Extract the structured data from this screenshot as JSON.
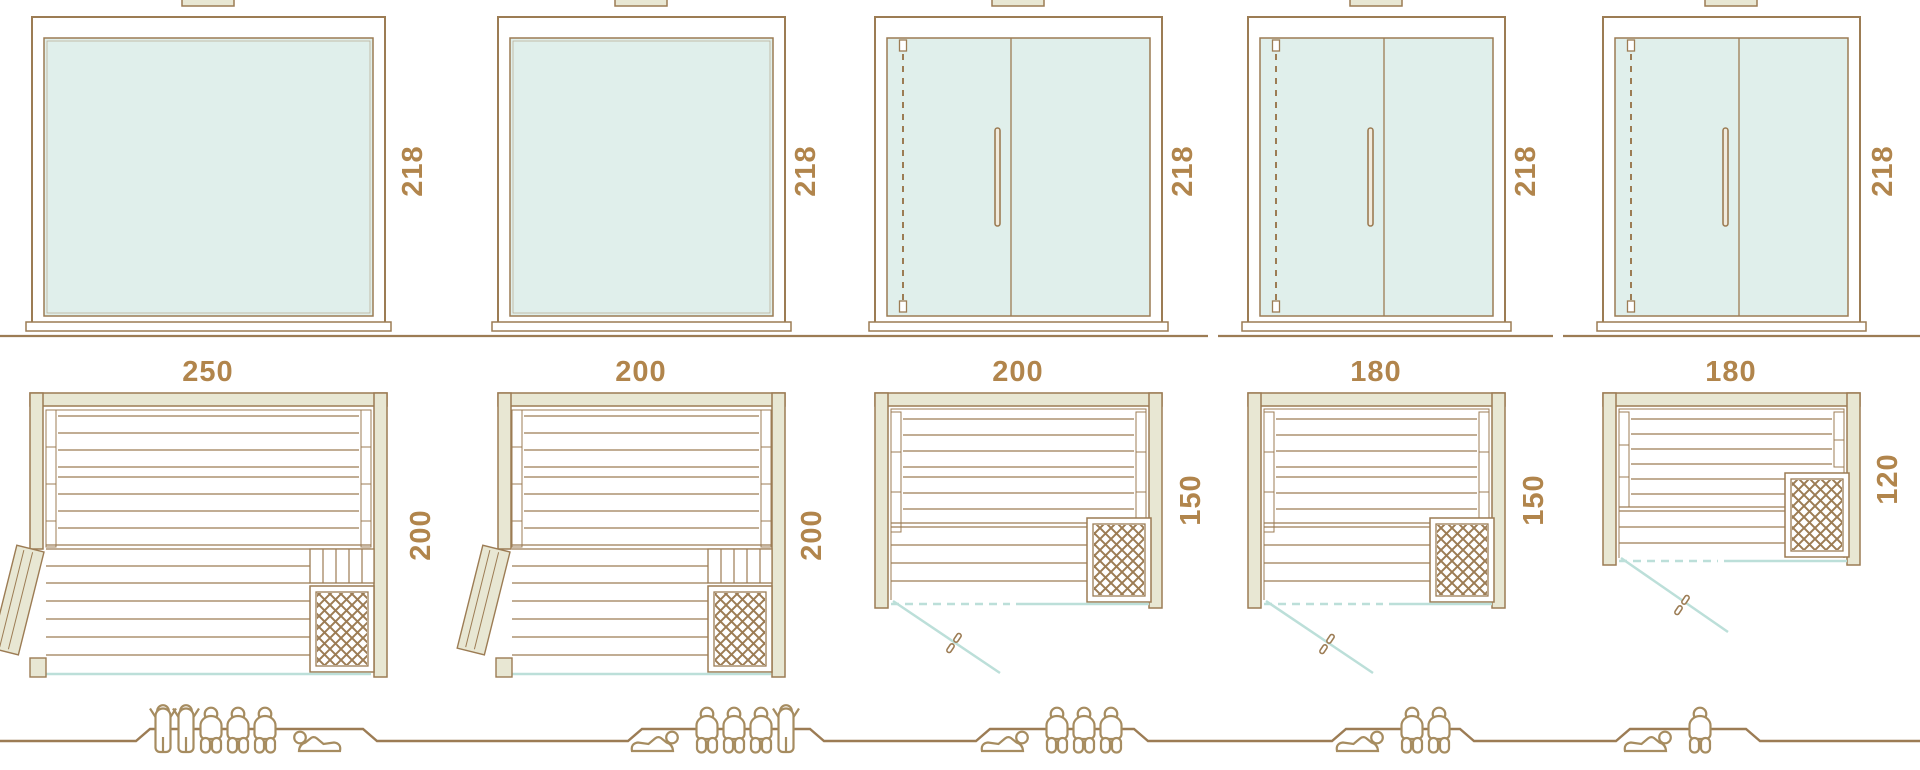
{
  "diagram": {
    "kind": "sauna-size-comparison-sheet",
    "views": [
      "front-elevation",
      "floor-plan",
      "capacity-figures"
    ]
  },
  "palette": {
    "line_brown": "#9c7c54",
    "label_brown": "#b1854c",
    "wall_fill": "#e8e7d3",
    "glass_fill": "#e0efeb",
    "glass_line_blue": "#bcdfd9",
    "people_brown": "#a68c60",
    "white": "#ffffff"
  },
  "saunas": [
    {
      "height": "218",
      "width": "250",
      "depth": "200",
      "front": "full-glass",
      "door": "hinged-side-door",
      "capacity": {
        "standing": 2,
        "sitting": 3,
        "lying": 1,
        "total": 6
      },
      "people": [
        "standing",
        "standing",
        "sitting",
        "sitting",
        "sitting",
        "lying-head-left"
      ]
    },
    {
      "height": "218",
      "width": "200",
      "depth": "200",
      "front": "full-glass",
      "door": "hinged-side-door",
      "capacity": {
        "standing": 1,
        "sitting": 3,
        "lying": 1,
        "total": 5
      },
      "people": [
        "lying-head-right",
        "sitting",
        "sitting",
        "sitting",
        "standing"
      ]
    },
    {
      "height": "218",
      "width": "200",
      "depth": "150",
      "front": "glass-with-door",
      "door": "glass-front-door",
      "capacity": {
        "standing": 0,
        "sitting": 3,
        "lying": 1,
        "total": 4
      },
      "people": [
        "lying-head-right",
        "sitting",
        "sitting",
        "sitting"
      ]
    },
    {
      "height": "218",
      "width": "180",
      "depth": "150",
      "front": "glass-with-door",
      "door": "glass-front-door",
      "capacity": {
        "standing": 0,
        "sitting": 2,
        "lying": 1,
        "total": 3
      },
      "people": [
        "lying-head-right",
        "sitting",
        "sitting"
      ]
    },
    {
      "height": "218",
      "width": "180",
      "depth": "120",
      "front": "glass-with-door",
      "door": "glass-front-door",
      "capacity": {
        "standing": 0,
        "sitting": 1,
        "lying": 1,
        "total": 2
      },
      "people": [
        "lying-head-right",
        "sitting"
      ]
    }
  ]
}
